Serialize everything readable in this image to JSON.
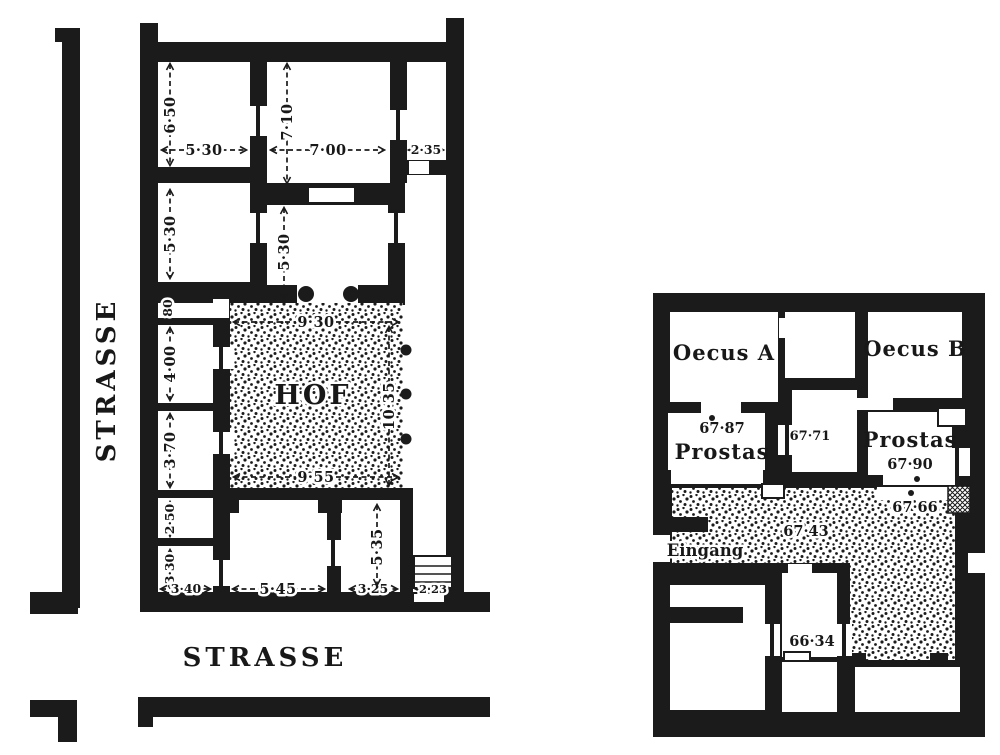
{
  "colors": {
    "ink": "#1b1b1b",
    "paper": "#ffffff"
  },
  "left_plan": {
    "street_left_label": "STRASSE",
    "street_bottom_label": "STRASSE",
    "courtyard_label": "HOF",
    "dims": {
      "a_h": "6·50",
      "a_w": "5·30",
      "b_h": "7·10",
      "b_w": "7·00",
      "c_w": "2·35",
      "d_h": "5·30",
      "e_h": "5·30",
      "passage_w": "80",
      "f_h": "4·00",
      "g_h": "3·70",
      "hof_top_w": "9·30",
      "hof_side_h": "10·35",
      "hof_bottom_w": "9·55",
      "h_h": "2·50",
      "i_h": "3·30",
      "i_w": "3·40",
      "j_w": "5·45",
      "k_w": "3·25",
      "k_h": "5·35",
      "corridor_w": "2·23"
    }
  },
  "right_plan": {
    "oecus_a_label": "Oecus A",
    "oecus_b_label": "Oecus B",
    "prostas_left_label": "Prostas",
    "prostas_left_elev": "67·87",
    "middle_room_elev": "67·71",
    "prostas_right_label": "Prostas",
    "prostas_right_elev": "67·90",
    "court_threshold_elev": "67·66",
    "court_elev": "67·43",
    "entrance_label": "Eingang",
    "south_room_elev": "66·34"
  }
}
